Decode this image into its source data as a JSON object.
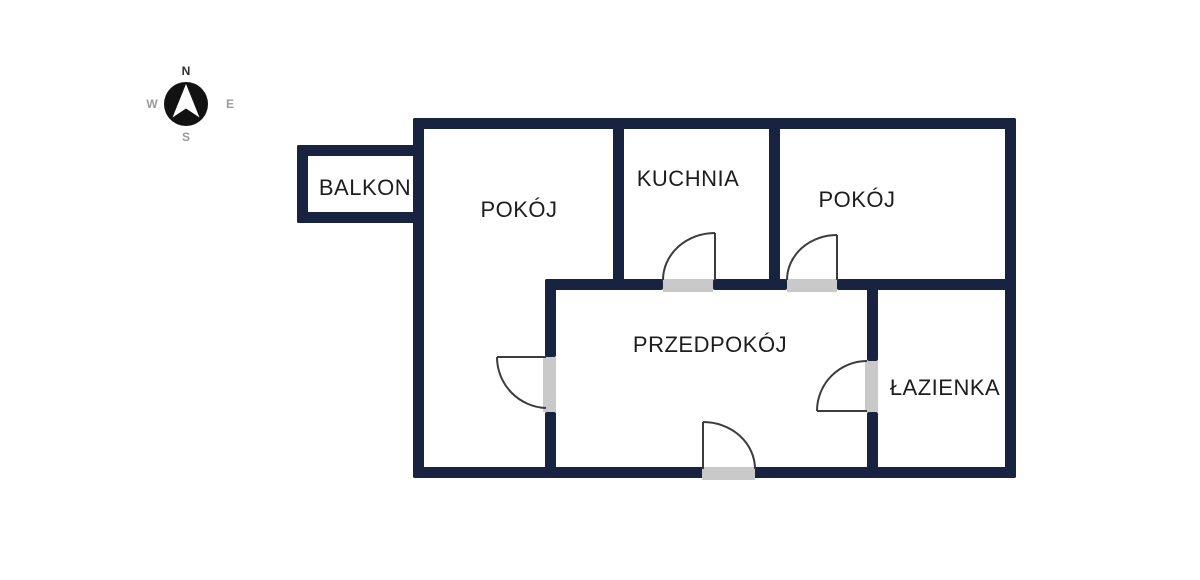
{
  "title": "apartment-floor-plan",
  "colors": {
    "wall": "#172340",
    "door_opening": "#c9c9c9",
    "door_stroke": "#3c3c3c",
    "text": "#1d1d1d",
    "compass_circle": "#121212",
    "compass_arrow": "#ffffff",
    "compass_letter": "#2e2e2e",
    "compass_letter_muted": "#9a9a9a"
  },
  "compass": {
    "n": "N",
    "e": "E",
    "s": "S",
    "w": "W"
  },
  "rooms": [
    {
      "id": "balkon",
      "label": "BALKON"
    },
    {
      "id": "pokoj-left",
      "label": "POKÓJ"
    },
    {
      "id": "kuchnia",
      "label": "KUCHNIA"
    },
    {
      "id": "pokoj-right",
      "label": "POKÓJ"
    },
    {
      "id": "przedpokoj",
      "label": "PRZEDPOKÓJ"
    },
    {
      "id": "lazienka",
      "label": "ŁAZIENKA"
    }
  ]
}
